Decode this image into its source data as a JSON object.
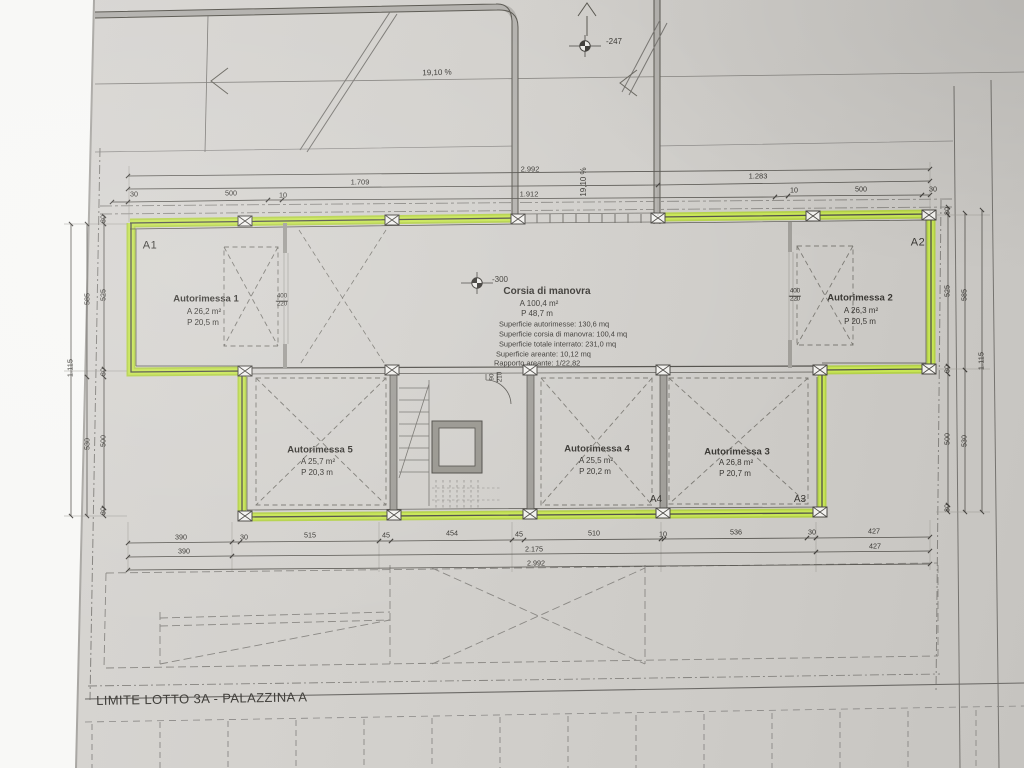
{
  "colors": {
    "paper": "#d3d1cd",
    "highlight": "#c9e755",
    "highlight_dark": "#b1d13c",
    "line": "#514f4a"
  },
  "boundary": {
    "limit_label": "LIMITE LOTTO 3A - PALAZZINA A"
  },
  "slopes": {
    "top_ramp": "19,10 %",
    "entry_ramp": "19,10 %"
  },
  "levels": {
    "street": "-247",
    "garage": "-300"
  },
  "rooms": {
    "a1": {
      "code": "A1",
      "title": "Autorimessa 1",
      "area": "A 26,2 m²",
      "perimeter": "P 20,5 m",
      "door": {
        "n": "400",
        "d": "220"
      }
    },
    "a2": {
      "code": "A2",
      "title": "Autorimessa 2",
      "area": "A 26,3 m²",
      "perimeter": "P 20,5 m",
      "door": {
        "n": "400",
        "d": "220"
      }
    },
    "a3": {
      "code": "A3",
      "title": "Autorimessa 3",
      "area": "A 26,8 m²",
      "perimeter": "P 20,7 m"
    },
    "a4": {
      "code": "A4",
      "title": "Autorimessa 4",
      "area": "A 25,5 m²",
      "perimeter": "P 20,2 m"
    },
    "a5": {
      "title": "Autorimessa 5",
      "area": "A 25,7 m²",
      "perimeter": "P 20,3 m"
    },
    "corsia": {
      "title": "Corsia di manovra",
      "area": "A 100,4 m²",
      "perimeter": "P 48,7 m",
      "stats": [
        "Superficie autorimesse: 130,6 mq",
        "Superficie corsia di manovra: 100,4 mq",
        "Superficie totale interrato: 231,0 mq",
        "Superficie areante: 10,12 mq",
        "Rapporto areante: 1/22,82"
      ]
    },
    "stair_door": {
      "n": "90",
      "d": "210"
    }
  },
  "dims": {
    "top": {
      "total": "2.992",
      "left": "1.709",
      "right": "1.283",
      "ramp": "1.912",
      "left_small": [
        "30",
        "500",
        "10"
      ],
      "right_small": [
        "10",
        "500",
        "30"
      ]
    },
    "bottom": {
      "row1": [
        "390",
        "30",
        "515",
        "45",
        "454",
        "45",
        "510",
        "10",
        "536",
        "30",
        "427"
      ],
      "row2": [
        "390",
        "2.175",
        "427"
      ],
      "row3": "2.992"
    },
    "left": {
      "outer": "1.115",
      "mid": [
        "585",
        "530"
      ],
      "inner": [
        "30",
        "525",
        "30",
        "500",
        "30"
      ]
    },
    "right": {
      "outer": "1.115",
      "mid": [
        "585",
        "530"
      ],
      "inner": [
        "30",
        "525",
        "30",
        "500",
        "30"
      ]
    }
  }
}
